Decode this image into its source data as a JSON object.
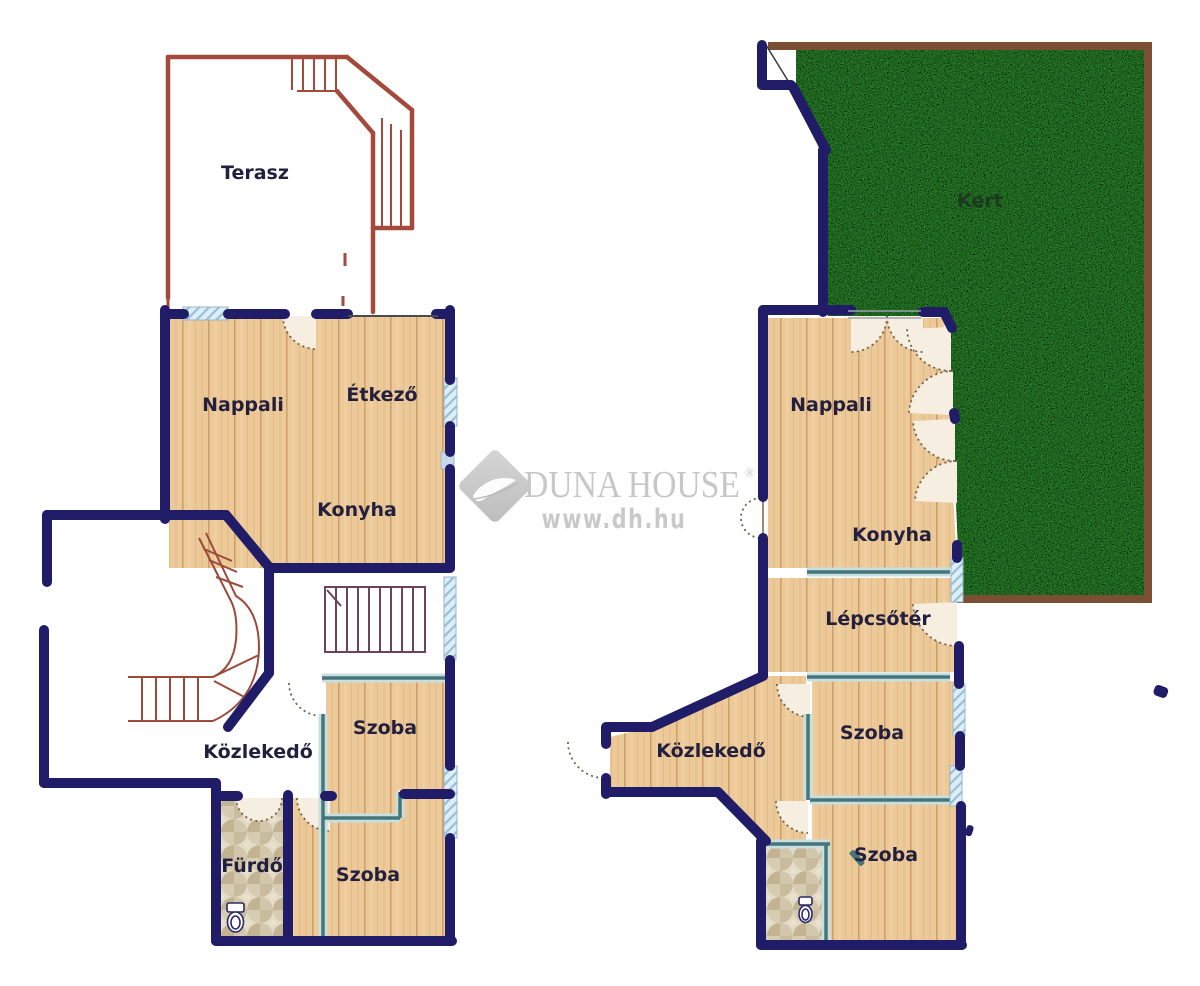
{
  "watermark": {
    "brand": "DUNA HOUSE",
    "registered": "®",
    "url": "www.dh.hu"
  },
  "left_plan": {
    "terasz": "Terasz",
    "nappali": "Nappali",
    "etkezo": "Étkező",
    "konyha": "Konyha",
    "kozlekedo": "Közlekedő",
    "szoba1": "Szoba",
    "szoba2": "Szoba",
    "furdo": "Fürdő"
  },
  "right_plan": {
    "kert": "Kert",
    "nappali": "Nappali",
    "konyha": "Konyha",
    "lepcsoter": "Lépcsőtér",
    "szoba1": "Szoba",
    "kozlekedo": "Közlekedő",
    "szoba2": "Szoba"
  },
  "colors": {
    "wall_navy": "#211c68",
    "partition_teal": "#45767a",
    "partition_light": "#c9dedf",
    "wood_floor": "#ecc998",
    "terrace_brick": "#a34a3d",
    "grass_green": "#2e8b2e",
    "garden_border_brown": "#7b4f33",
    "tile_beige": "#ddd3bd",
    "window_blue": "#ddeef7",
    "label_text": "#23203f",
    "watermark_gray": "#c7c7c7"
  }
}
